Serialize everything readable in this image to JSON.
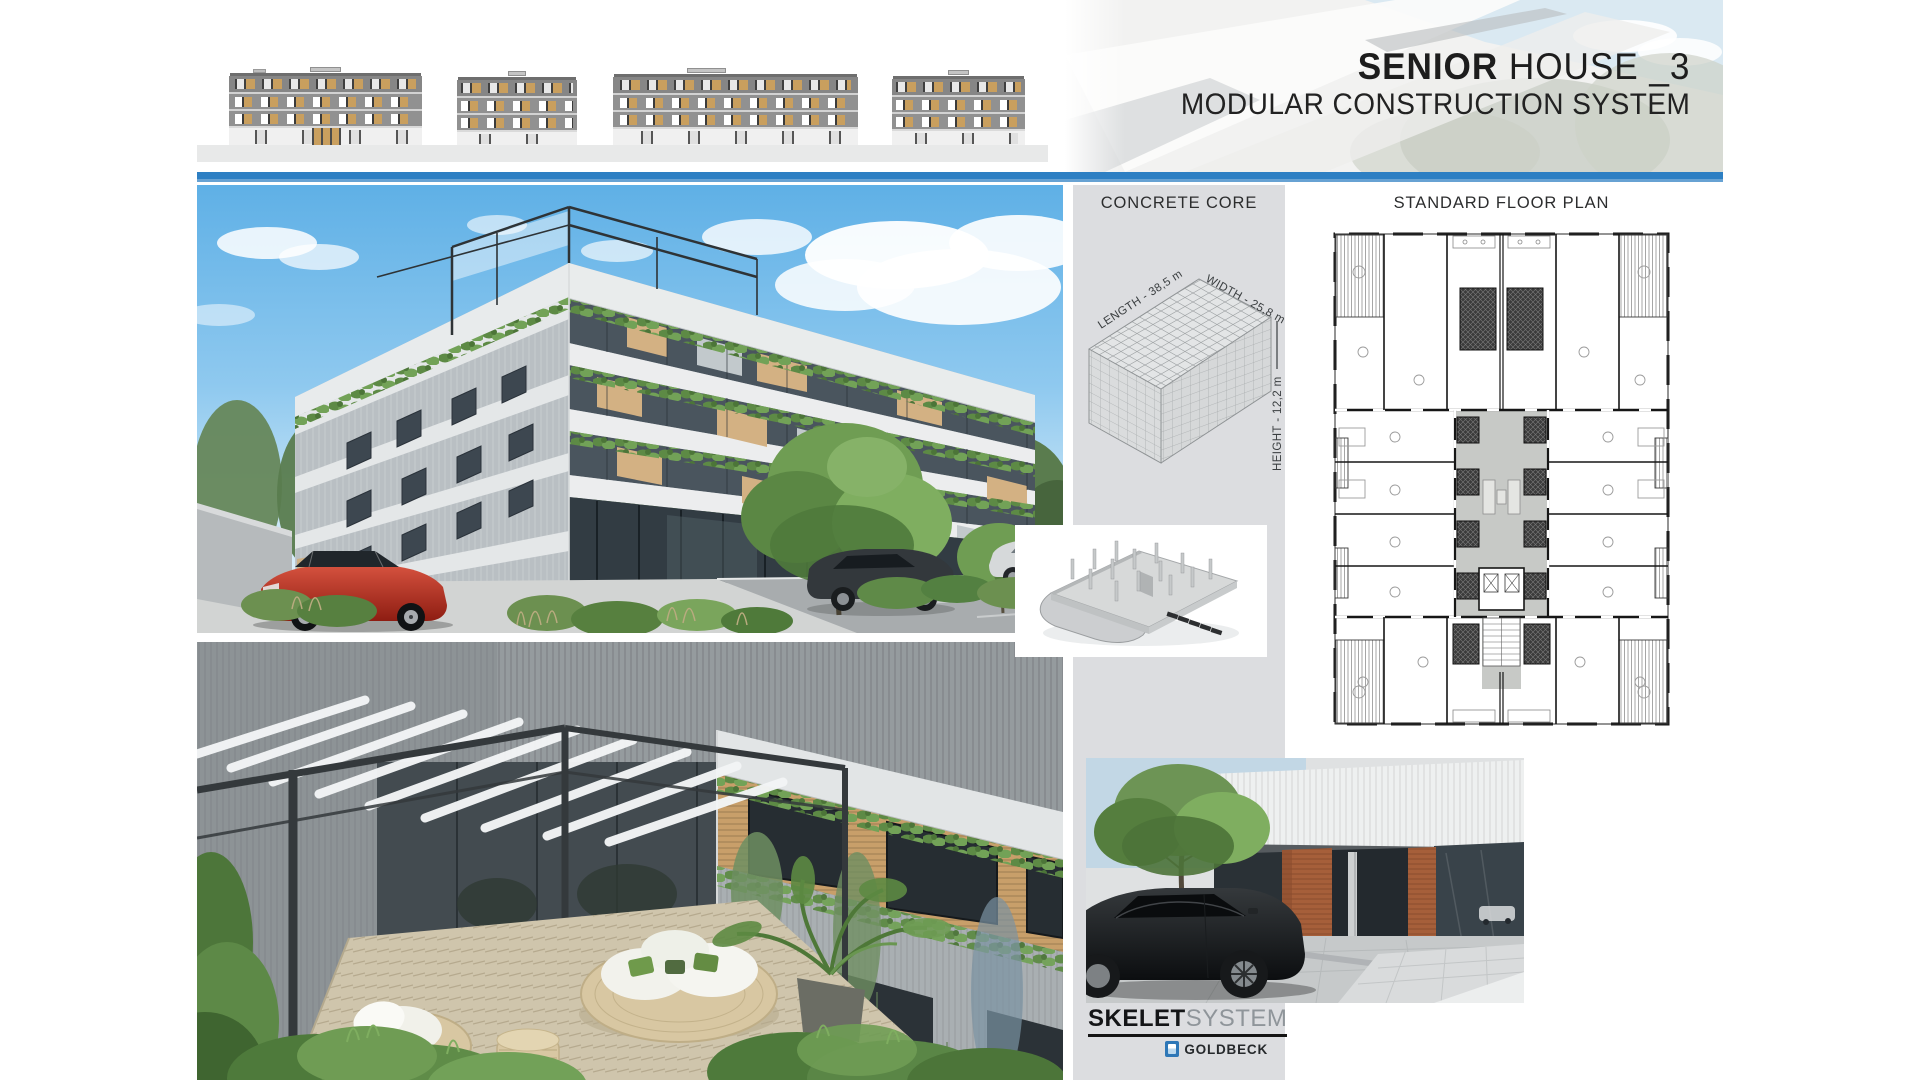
{
  "header": {
    "title_primary": "SENIOR",
    "title_secondary": " HOUSE _3",
    "subtitle": "MODULAR CONSTRUCTION SYSTEM"
  },
  "panels": {
    "concrete_core": {
      "heading": "CONCRETE CORE",
      "length_label": "LENGTH - 38,5 m",
      "width_label": "WIDTH - 25,8 m",
      "height_label": "HEIGHT - 12,2 m"
    },
    "floor_plan": {
      "heading": "STANDARD FLOOR PLAN"
    }
  },
  "footer": {
    "brand_primary": "SKELET",
    "brand_secondary": "SYSTEM",
    "partner_name": "GOLDBECK"
  },
  "colors": {
    "accent_blue": "#2d7fc3",
    "panel_gray": "#dcdde0",
    "goldbeck_blue": "#2e77b7"
  }
}
